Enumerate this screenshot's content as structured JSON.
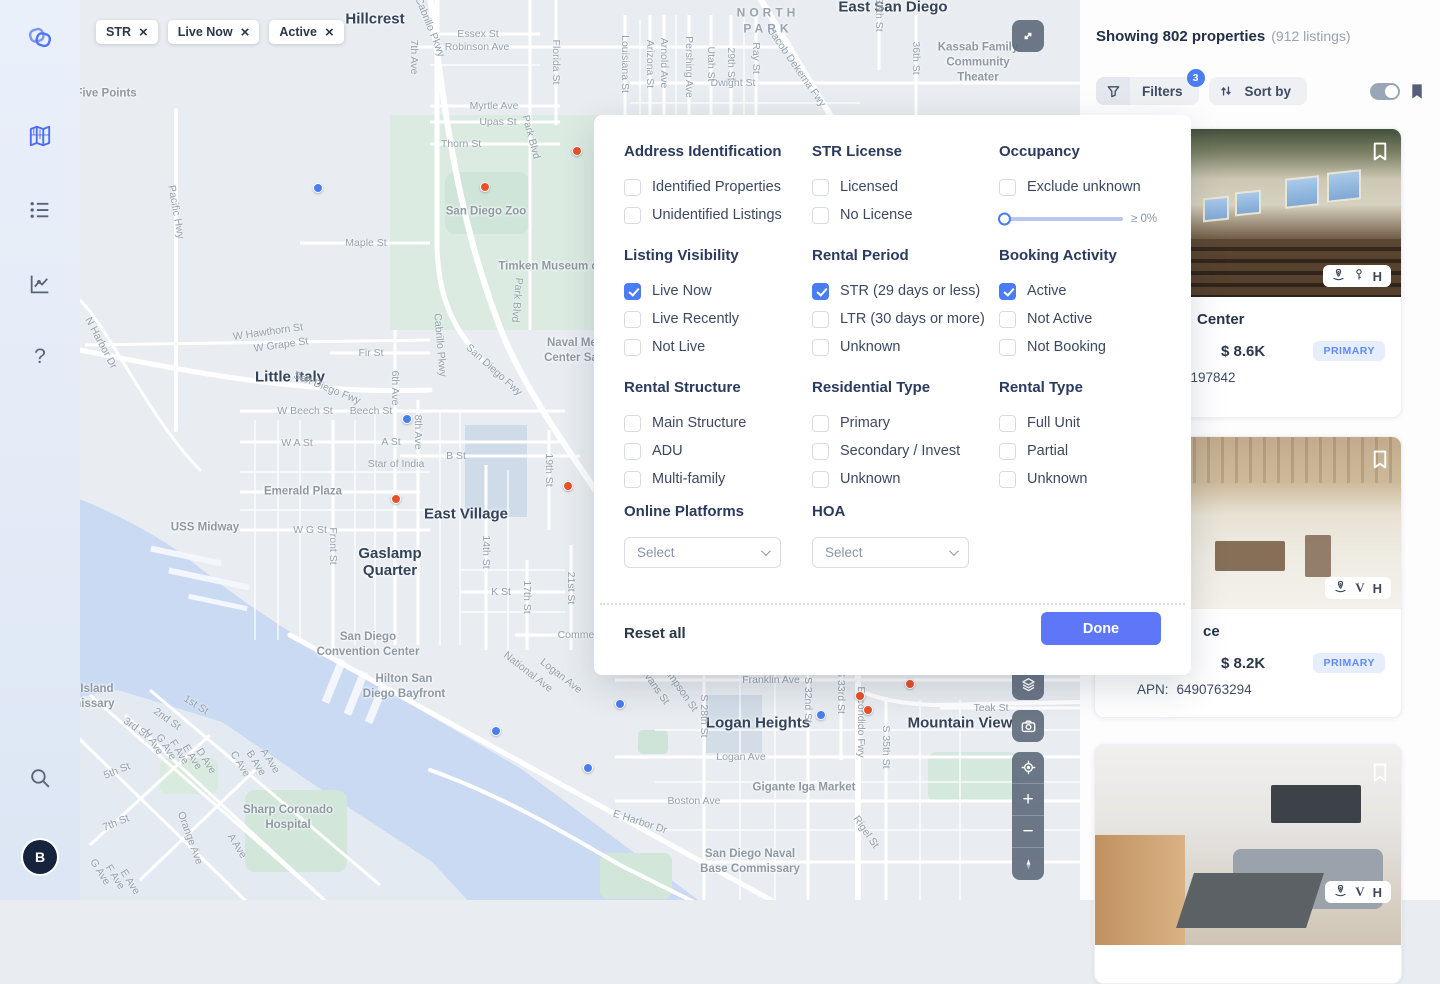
{
  "colors": {
    "accent": "#4a6cf7",
    "marker_orange": "#e8512c",
    "marker_blue": "#4a7df0",
    "done_button": "#5d77f8",
    "badge_blue": "#4a7df0"
  },
  "sidebar": {
    "items": [
      {
        "name": "logo"
      },
      {
        "name": "map-nav",
        "active": true
      },
      {
        "name": "list-nav"
      },
      {
        "name": "analytics-nav"
      },
      {
        "name": "help-nav"
      },
      {
        "name": "search-nav"
      }
    ],
    "avatar_initial": "B"
  },
  "map": {
    "chips": [
      {
        "label": "STR"
      },
      {
        "label": "Live Now"
      },
      {
        "label": "Active"
      }
    ],
    "controls": [
      "expand-icon",
      "layers-icon",
      "camera-icon",
      "locate-icon",
      "zoom-in-icon",
      "zoom-out-icon",
      "compass-icon"
    ],
    "labels": [
      {
        "t": "Hillcrest",
        "x": 375,
        "y": 19,
        "type": "area"
      },
      {
        "t": "East San Diego",
        "x": 893,
        "y": 7,
        "type": "area"
      },
      {
        "t": "Little Italy",
        "x": 290,
        "y": 377,
        "type": "area"
      },
      {
        "t": "East Village",
        "x": 466,
        "y": 514,
        "type": "area"
      },
      {
        "t": "Gaslamp\nQuarter",
        "x": 390,
        "y": 562,
        "type": "area"
      },
      {
        "t": "Logan Heights",
        "x": 758,
        "y": 723,
        "type": "area"
      },
      {
        "t": "Mountain View",
        "x": 960,
        "y": 723,
        "type": "area"
      },
      {
        "t": "NORTH\nPARK",
        "x": 768,
        "y": 21,
        "type": "district"
      },
      {
        "t": "San Diego Zoo",
        "x": 486,
        "y": 212,
        "type": "poi"
      },
      {
        "t": "Timken Museum of Art",
        "x": 560,
        "y": 267,
        "type": "poi"
      },
      {
        "t": "Naval Medical\nCenter San Die",
        "x": 585,
        "y": 351,
        "type": "poi"
      },
      {
        "t": "Kassab Family\nCommunity Theater",
        "x": 978,
        "y": 63,
        "type": "poi"
      },
      {
        "t": "Emerald Plaza",
        "x": 303,
        "y": 492,
        "type": "poi"
      },
      {
        "t": "USS Midway",
        "x": 205,
        "y": 528,
        "type": "poi"
      },
      {
        "t": "San Diego\nConvention Center",
        "x": 368,
        "y": 645,
        "type": "poi"
      },
      {
        "t": "Hilton San\nDiego Bayfront",
        "x": 404,
        "y": 687,
        "type": "poi"
      },
      {
        "t": "Gigante Iga Market",
        "x": 804,
        "y": 788,
        "type": "poi"
      },
      {
        "t": "San Diego Naval\nBase Commissary",
        "x": 750,
        "y": 862,
        "type": "poi"
      },
      {
        "t": "Sharp Coronado\nHospital",
        "x": 288,
        "y": 818,
        "type": "poi"
      },
      {
        "t": "North Island\nCommissary",
        "x": 80,
        "y": 697,
        "type": "poi"
      },
      {
        "t": "Five Points",
        "x": 106,
        "y": 94,
        "type": "poi"
      },
      {
        "t": "Star of India",
        "x": 396,
        "y": 464,
        "type": "street"
      },
      {
        "t": "Essex St",
        "x": 478,
        "y": 34,
        "type": "street"
      },
      {
        "t": "Robinson Ave",
        "x": 477,
        "y": 47,
        "type": "street"
      },
      {
        "t": "Dwight St",
        "x": 733,
        "y": 83,
        "type": "street"
      },
      {
        "t": "Myrtle Ave",
        "x": 494,
        "y": 106,
        "type": "street"
      },
      {
        "t": "Upas St",
        "x": 498,
        "y": 122,
        "type": "street"
      },
      {
        "t": "Thorn St",
        "x": 461,
        "y": 144,
        "type": "street"
      },
      {
        "t": "Maple St",
        "x": 366,
        "y": 243,
        "type": "street"
      },
      {
        "t": "Fir St",
        "x": 371,
        "y": 353,
        "type": "street"
      },
      {
        "t": "W Grape St",
        "x": 281,
        "y": 345,
        "type": "street",
        "r": -8
      },
      {
        "t": "W Hawthorn St",
        "x": 268,
        "y": 332,
        "type": "street",
        "r": -8
      },
      {
        "t": "W Beech St",
        "x": 305,
        "y": 411,
        "type": "street"
      },
      {
        "t": "Beech St",
        "x": 371,
        "y": 411,
        "type": "street"
      },
      {
        "t": "W A St",
        "x": 297,
        "y": 443,
        "type": "street"
      },
      {
        "t": "A St",
        "x": 391,
        "y": 442,
        "type": "street"
      },
      {
        "t": "B St",
        "x": 456,
        "y": 456,
        "type": "street"
      },
      {
        "t": "W G St",
        "x": 310,
        "y": 530,
        "type": "street"
      },
      {
        "t": "K St",
        "x": 501,
        "y": 592,
        "type": "street"
      },
      {
        "t": "Commercial St",
        "x": 592,
        "y": 635,
        "type": "street"
      },
      {
        "t": "Franklin Ave",
        "x": 771,
        "y": 680,
        "type": "street"
      },
      {
        "t": "Logan Ave",
        "x": 741,
        "y": 757,
        "type": "street"
      },
      {
        "t": "Boston Ave",
        "x": 694,
        "y": 801,
        "type": "street"
      },
      {
        "t": "Teak St",
        "x": 991,
        "y": 708,
        "type": "street"
      },
      {
        "t": "E Harbor Dr",
        "x": 640,
        "y": 822,
        "type": "street",
        "r": 18
      },
      {
        "t": "5th St",
        "x": 117,
        "y": 771,
        "type": "street",
        "r": -22
      },
      {
        "t": "7th St",
        "x": 116,
        "y": 823,
        "type": "street",
        "r": -22
      },
      {
        "t": "7th Ave",
        "x": 414,
        "y": 57,
        "type": "street",
        "r": 90
      },
      {
        "t": "Florida St",
        "x": 556,
        "y": 62,
        "type": "street",
        "r": 90
      },
      {
        "t": "Louisiana St",
        "x": 625,
        "y": 64,
        "type": "street",
        "r": 90
      },
      {
        "t": "Arizona St",
        "x": 650,
        "y": 64,
        "type": "street",
        "r": 90
      },
      {
        "t": "Arnold Ave",
        "x": 664,
        "y": 63,
        "type": "street",
        "r": 90
      },
      {
        "t": "Pershing Ave",
        "x": 689,
        "y": 67,
        "type": "street",
        "r": 90
      },
      {
        "t": "Utah St",
        "x": 711,
        "y": 64,
        "type": "street",
        "r": 90
      },
      {
        "t": "29th St",
        "x": 731,
        "y": 64,
        "type": "street",
        "r": 90
      },
      {
        "t": "Ray St",
        "x": 756,
        "y": 58,
        "type": "street",
        "r": 90
      },
      {
        "t": "35th St",
        "x": 879,
        "y": 15,
        "type": "street",
        "r": 90
      },
      {
        "t": "36th St",
        "x": 916,
        "y": 58,
        "type": "street",
        "r": 90
      },
      {
        "t": "Park Blvd",
        "x": 531,
        "y": 137,
        "type": "street",
        "r": 75
      },
      {
        "t": "Park Blvd",
        "x": 517,
        "y": 300,
        "type": "street",
        "r": 95
      },
      {
        "t": "Cabrillo Pkwy",
        "x": 430,
        "y": 27,
        "type": "street",
        "r": 68
      },
      {
        "t": "Cabrillo Pkwy",
        "x": 440,
        "y": 345,
        "type": "street",
        "r": 85
      },
      {
        "t": "Jacob Dekema Fwy",
        "x": 797,
        "y": 68,
        "type": "street",
        "r": 55
      },
      {
        "t": "San Diego Fwy",
        "x": 327,
        "y": 388,
        "type": "street",
        "r": 22
      },
      {
        "t": "San Diego Fwy",
        "x": 494,
        "y": 370,
        "type": "street",
        "r": 42
      },
      {
        "t": "6th Ave",
        "x": 395,
        "y": 388,
        "type": "street",
        "r": 90
      },
      {
        "t": "8th Ave",
        "x": 418,
        "y": 432,
        "type": "street",
        "r": 90
      },
      {
        "t": "Pacific Hwy",
        "x": 176,
        "y": 212,
        "type": "street",
        "r": 80
      },
      {
        "t": "N Harbor Dr",
        "x": 101,
        "y": 343,
        "type": "street",
        "r": 62
      },
      {
        "t": "Front St",
        "x": 333,
        "y": 546,
        "type": "street",
        "r": 90
      },
      {
        "t": "14th St",
        "x": 486,
        "y": 552,
        "type": "street",
        "r": 90
      },
      {
        "t": "17th St",
        "x": 527,
        "y": 597,
        "type": "street",
        "r": 90
      },
      {
        "t": "19th St",
        "x": 549,
        "y": 470,
        "type": "street",
        "r": 90
      },
      {
        "t": "21st St",
        "x": 571,
        "y": 588,
        "type": "street",
        "r": 90
      },
      {
        "t": "S 28th St",
        "x": 704,
        "y": 716,
        "type": "street",
        "r": 90
      },
      {
        "t": "S 32nd St",
        "x": 808,
        "y": 700,
        "type": "street",
        "r": 90
      },
      {
        "t": "S 33rd St",
        "x": 841,
        "y": 692,
        "type": "street",
        "r": 90
      },
      {
        "t": "Escondido Fwy",
        "x": 861,
        "y": 722,
        "type": "street",
        "r": 90
      },
      {
        "t": "S 35th St",
        "x": 886,
        "y": 747,
        "type": "street",
        "r": 90
      },
      {
        "t": "Rigel St",
        "x": 866,
        "y": 832,
        "type": "street",
        "r": 55
      },
      {
        "t": "Sampson St",
        "x": 679,
        "y": 687,
        "type": "street",
        "r": 55
      },
      {
        "t": "S Evans St",
        "x": 652,
        "y": 682,
        "type": "street",
        "r": 55
      },
      {
        "t": "National Ave",
        "x": 528,
        "y": 672,
        "type": "street",
        "r": 38
      },
      {
        "t": "Logan Ave",
        "x": 561,
        "y": 676,
        "type": "street",
        "r": 38
      },
      {
        "t": "Orange Ave",
        "x": 190,
        "y": 838,
        "type": "street",
        "r": 70
      },
      {
        "t": "1st St",
        "x": 196,
        "y": 705,
        "type": "street",
        "r": 32
      },
      {
        "t": "2nd St",
        "x": 167,
        "y": 719,
        "type": "street",
        "r": 35
      },
      {
        "t": "3rd St",
        "x": 136,
        "y": 728,
        "type": "street",
        "r": 35
      },
      {
        "t": "H Ave",
        "x": 153,
        "y": 742,
        "type": "street",
        "r": 58
      },
      {
        "t": "G Ave",
        "x": 166,
        "y": 747,
        "type": "street",
        "r": 58
      },
      {
        "t": "F Ave",
        "x": 179,
        "y": 752,
        "type": "street",
        "r": 58
      },
      {
        "t": "E Ave",
        "x": 192,
        "y": 757,
        "type": "street",
        "r": 58
      },
      {
        "t": "D Ave",
        "x": 206,
        "y": 761,
        "type": "street",
        "r": 58
      },
      {
        "t": "C Ave",
        "x": 240,
        "y": 764,
        "type": "street",
        "r": 58
      },
      {
        "t": "B Ave",
        "x": 256,
        "y": 763,
        "type": "street",
        "r": 58
      },
      {
        "t": "A Ave",
        "x": 270,
        "y": 761,
        "type": "street",
        "r": 58
      },
      {
        "t": "A Ave",
        "x": 237,
        "y": 846,
        "type": "street",
        "r": 58
      },
      {
        "t": "G Ave",
        "x": 100,
        "y": 872,
        "type": "street",
        "r": 58
      },
      {
        "t": "F Ave",
        "x": 115,
        "y": 877,
        "type": "street",
        "r": 58
      },
      {
        "t": "E Ave",
        "x": 130,
        "y": 882,
        "type": "street",
        "r": 58
      }
    ],
    "markers": [
      {
        "x": 577,
        "y": 151,
        "c": "orange"
      },
      {
        "x": 485,
        "y": 187,
        "c": "orange"
      },
      {
        "x": 568,
        "y": 486,
        "c": "orange"
      },
      {
        "x": 396,
        "y": 499,
        "c": "orange"
      },
      {
        "x": 910,
        "y": 684,
        "c": "orange"
      },
      {
        "x": 860,
        "y": 696,
        "c": "orange"
      },
      {
        "x": 868,
        "y": 710,
        "c": "orange"
      },
      {
        "x": 318,
        "y": 188,
        "c": "blue"
      },
      {
        "x": 407,
        "y": 419,
        "c": "blue"
      },
      {
        "x": 620,
        "y": 704,
        "c": "blue"
      },
      {
        "x": 821,
        "y": 715,
        "c": "blue"
      },
      {
        "x": 496,
        "y": 731,
        "c": "blue"
      },
      {
        "x": 588,
        "y": 768,
        "c": "blue"
      }
    ]
  },
  "filter_panel": {
    "groups": [
      {
        "title": "Address Identification",
        "items": [
          {
            "label": "Identified Properties",
            "checked": false
          },
          {
            "label": "Unidentified Listings",
            "checked": false
          }
        ]
      },
      {
        "title": "STR License",
        "items": [
          {
            "label": "Licensed",
            "checked": false
          },
          {
            "label": "No License",
            "checked": false
          }
        ]
      },
      {
        "title": "Listing Visibility",
        "items": [
          {
            "label": "Live Now",
            "checked": true
          },
          {
            "label": "Live Recently",
            "checked": false
          },
          {
            "label": "Not Live",
            "checked": false
          }
        ]
      },
      {
        "title": "Rental Period",
        "items": [
          {
            "label": "STR (29 days or less)",
            "checked": true
          },
          {
            "label": "LTR (30 days or more)",
            "checked": false
          },
          {
            "label": "Unknown",
            "checked": false
          }
        ]
      },
      {
        "title": "Booking Activity",
        "items": [
          {
            "label": "Active",
            "checked": true
          },
          {
            "label": "Not Active",
            "checked": false
          },
          {
            "label": "Not Booking",
            "checked": false
          }
        ]
      },
      {
        "title": "Rental Structure",
        "items": [
          {
            "label": "Main Structure",
            "checked": false
          },
          {
            "label": "ADU",
            "checked": false
          },
          {
            "label": "Multi-family",
            "checked": false
          }
        ]
      },
      {
        "title": "Residential Type",
        "items": [
          {
            "label": "Primary",
            "checked": false
          },
          {
            "label": "Secondary / Invest",
            "checked": false
          },
          {
            "label": "Unknown",
            "checked": false
          }
        ]
      },
      {
        "title": "Rental Type",
        "items": [
          {
            "label": "Full Unit",
            "checked": false
          },
          {
            "label": "Partial",
            "checked": false
          },
          {
            "label": "Unknown",
            "checked": false
          }
        ]
      }
    ],
    "occupancy": {
      "title": "Occupancy",
      "checkbox": {
        "label": "Exclude unknown",
        "checked": false
      },
      "slider": {
        "value": 0,
        "label": "≥ 0%"
      }
    },
    "selects": [
      {
        "title": "Online Platforms",
        "value": "Select"
      },
      {
        "title": "HOA",
        "value": "Select"
      }
    ],
    "reset_label": "Reset all",
    "done_label": "Done"
  },
  "results": {
    "header": {
      "showing": "Showing 802 properties",
      "count": "(912 listings)"
    },
    "toolbar": {
      "filters_label": "Filters",
      "filters_badge": "3",
      "sort_label": "Sort by"
    },
    "cards": [
      {
        "title_fragment": "Center",
        "price": "$ 8.6K",
        "badge": "PRIMARY",
        "apn_label": "APN:",
        "apn_value": "197842",
        "platform_icons": [
          "airbnb-icon",
          "key-icon",
          "homes-icon"
        ]
      },
      {
        "title_fragment": "ce",
        "price": "$ 8.2K",
        "badge": "PRIMARY",
        "apn_label": "APN:",
        "apn_value": "6490763294",
        "platform_icons": [
          "airbnb-icon",
          "vrbo-icon",
          "homes-icon"
        ]
      },
      {
        "platform_icons": [
          "airbnb-icon",
          "vrbo-icon",
          "homes-icon"
        ]
      }
    ]
  }
}
